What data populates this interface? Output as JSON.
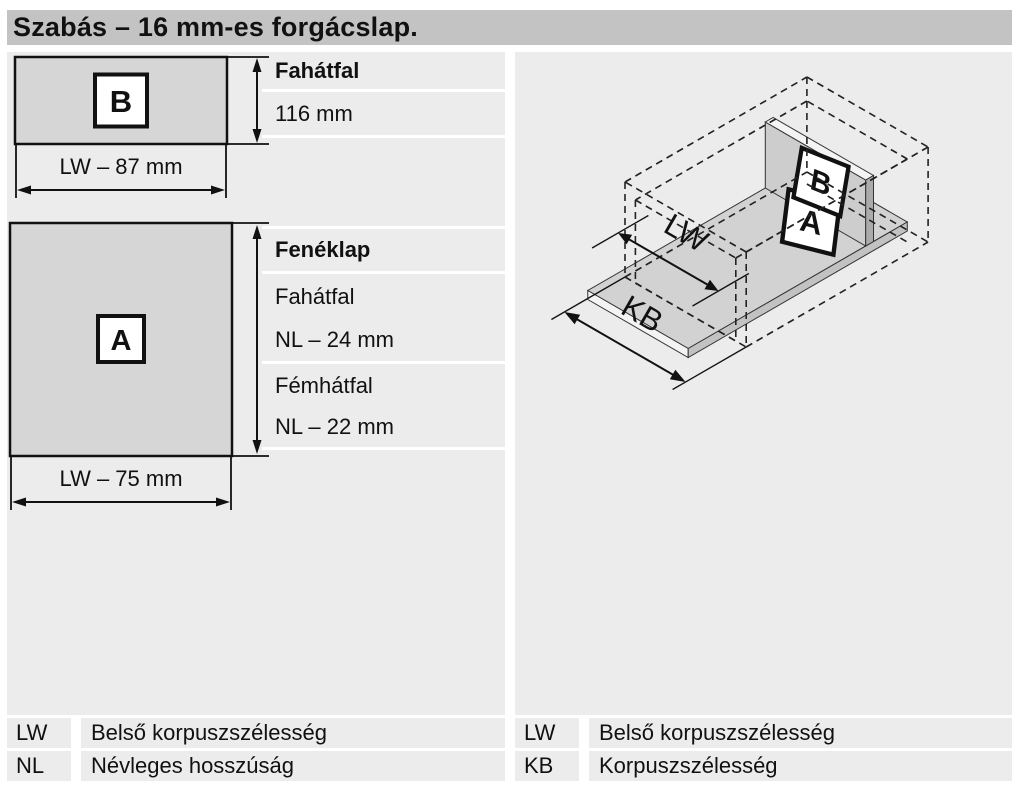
{
  "title": "Szabás – 16 mm-es forgácslap.",
  "part_b": {
    "marker": "B",
    "width_dim": "LW – 87 mm",
    "rows": [
      {
        "label": "Fahátfal"
      },
      {
        "label": "116 mm"
      }
    ]
  },
  "part_a": {
    "marker": "A",
    "width_dim": "LW – 75 mm",
    "rows": [
      {
        "label": "Fenéklap"
      },
      {
        "label": "Fahátfal"
      },
      {
        "label": "NL – 24 mm"
      },
      {
        "label": "Fémhátfal"
      },
      {
        "label": "NL – 22 mm"
      }
    ]
  },
  "iso": {
    "marker_a": "A",
    "marker_b": "B",
    "dim_inner": "LW",
    "dim_outer": "KB"
  },
  "legend_left": [
    {
      "abbr": "LW",
      "desc": "Belső korpuszszélesség"
    },
    {
      "abbr": "NL",
      "desc": "Névleges hosszúság"
    }
  ],
  "legend_right": [
    {
      "abbr": "LW",
      "desc": "Belső korpuszszélesség"
    },
    {
      "abbr": "KB",
      "desc": "Korpuszszélesség"
    }
  ],
  "colors": {
    "title_bar": "#c3c3c3",
    "content_bg": "#ececec",
    "part_fill": "#d6d6d6",
    "line": "#111111",
    "divider": "#ffffff"
  }
}
